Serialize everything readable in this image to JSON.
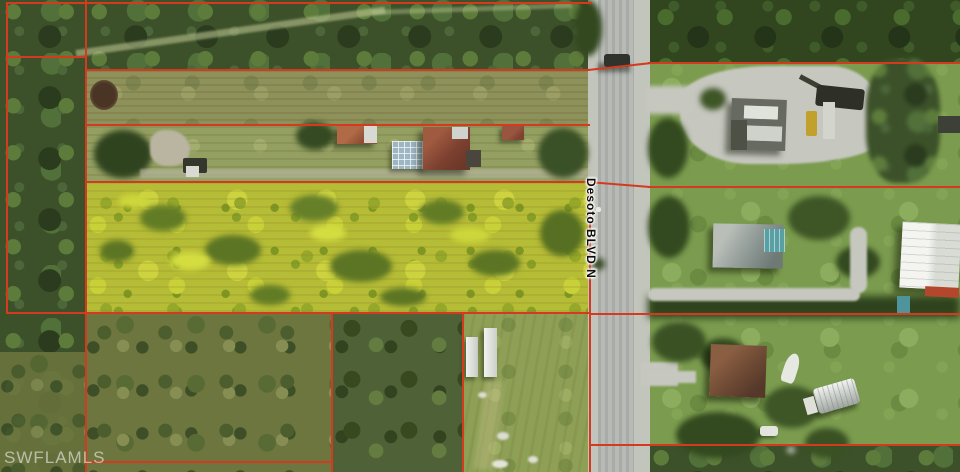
{
  "map": {
    "road_label": "Desoto BLVD N",
    "watermark": "SWFLAMLS",
    "colors": {
      "parcel_line": "#d43a1f",
      "highlight_parcel": "#b5bc35",
      "road": "#b3b6b1",
      "forest": "#3c5129",
      "lawn": "#7b9c4e"
    },
    "features": [
      "highlighted-vacant-parcel",
      "red-parcel-boundaries",
      "two-lane-road",
      "residential-houses",
      "pool-enclosures",
      "construction-equipment",
      "storage-trailers",
      "quonset-shed",
      "white-warehouse",
      "dirt-pond",
      "gravel-driveways",
      "forest-and-scrub"
    ]
  }
}
